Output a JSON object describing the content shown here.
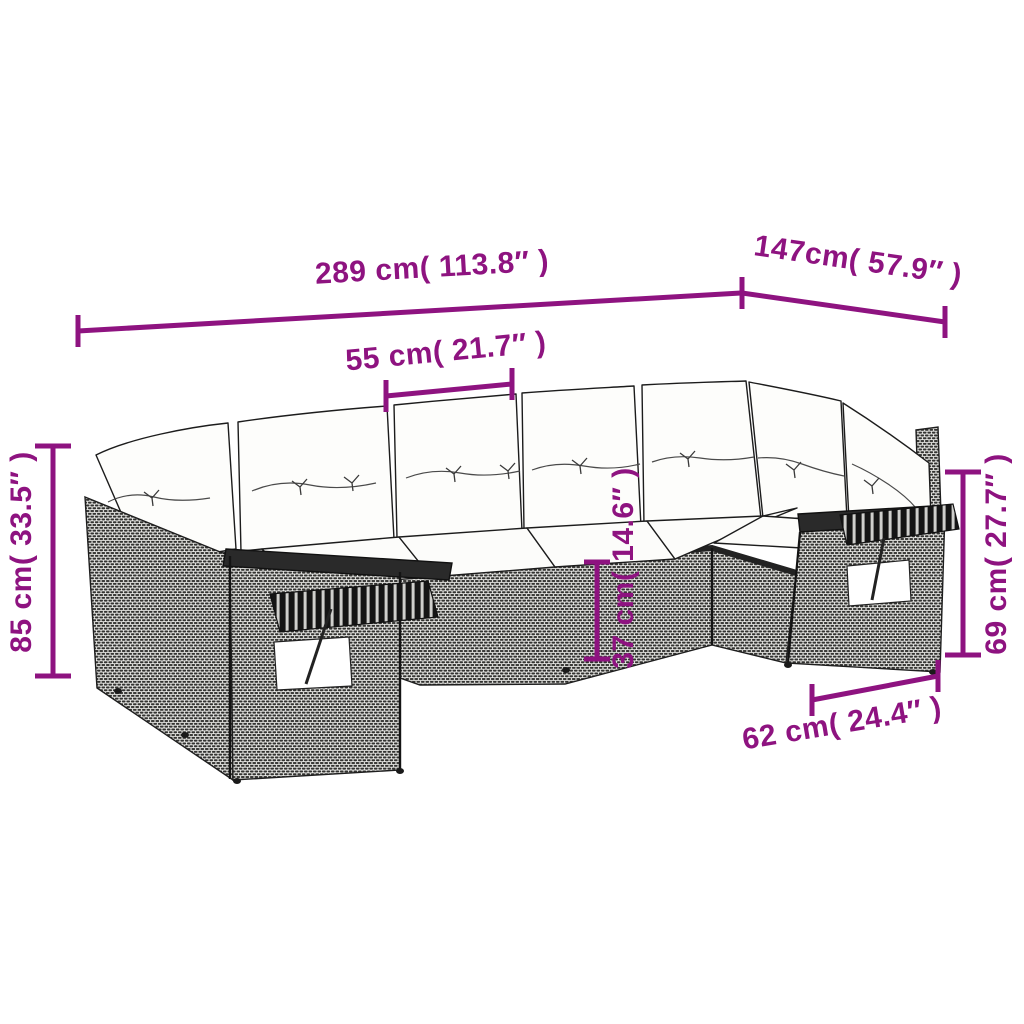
{
  "diagram": {
    "type": "product-dimension-diagram",
    "subject": "rattan garden corner sofa set with cushions",
    "background": "#ffffff",
    "accent_color": "#8E1380",
    "outline_color": "#1e1e1e",
    "dimensions": [
      {
        "id": "total-width",
        "label": "289 cm( 113.8″ )"
      },
      {
        "id": "right-depth",
        "label": "147cm( 57.9″ )"
      },
      {
        "id": "seat-width",
        "label": "55 cm( 21.7″ )"
      },
      {
        "id": "total-height",
        "label": "85 cm( 33.5″ )"
      },
      {
        "id": "armrest-height",
        "label": "69 cm( 27.7″ )"
      },
      {
        "id": "seat-height",
        "label": "37 cm( 14.6″ )"
      },
      {
        "id": "end-section-depth",
        "label": "62 cm( 24.4″ )"
      }
    ]
  }
}
